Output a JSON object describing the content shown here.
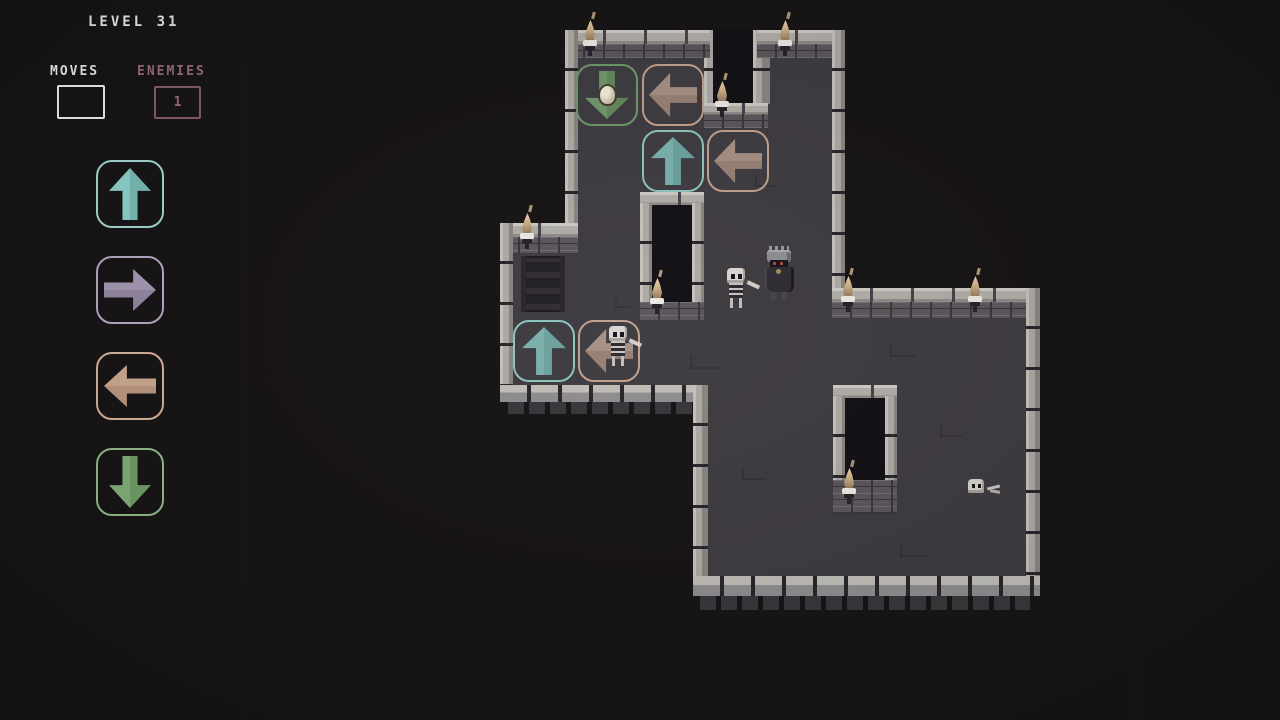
{
  "hud": {
    "level_label": "LEVEL 31",
    "moves": {
      "label": "MOVES",
      "value": ""
    },
    "enemies": {
      "label": "ENEMIES",
      "value": "1"
    }
  },
  "palette": {
    "background": "#171415",
    "floor": "#3f3c42",
    "wall_stone": "#b2afaa",
    "wall_brick": "#5b575c",
    "hud_text": "#ecebe8",
    "enemies_accent": "#9d6b80",
    "teal": "#8fd4cf",
    "lavender": "#a89bb5",
    "tan": "#cfac94",
    "green": "#83b17b",
    "torch_flame": "#c9a87f"
  },
  "controls": {
    "buttons": [
      {
        "direction": "up",
        "color": "teal"
      },
      {
        "direction": "right",
        "color": "lavender"
      },
      {
        "direction": "left",
        "color": "tan"
      },
      {
        "direction": "down",
        "color": "green"
      }
    ]
  },
  "board": {
    "placed_tiles": [
      {
        "direction": "down",
        "color": "green",
        "occupant": "egg-item",
        "position": "top room, upper row left"
      },
      {
        "direction": "left",
        "color": "tan",
        "occupant": "",
        "position": "top room, upper row right"
      },
      {
        "direction": "up",
        "color": "teal",
        "occupant": "",
        "position": "top room, lower row left"
      },
      {
        "direction": "left",
        "color": "tan",
        "occupant": "",
        "position": "top room, lower row right"
      },
      {
        "direction": "up",
        "color": "teal",
        "occupant": "",
        "position": "west room, left"
      },
      {
        "direction": "left",
        "color": "tan",
        "occupant": "skeleton",
        "position": "west room, right"
      }
    ],
    "entities": [
      {
        "type": "skeleton-swordsman",
        "position": "center hall, left of knight"
      },
      {
        "type": "armored-knight",
        "position": "center hall"
      },
      {
        "type": "skeleton-swordsman",
        "position": "standing on west left-arrow tile"
      },
      {
        "type": "egg-item",
        "position": "on green down-arrow tile"
      },
      {
        "type": "skull-debris",
        "position": "east room floor"
      }
    ],
    "decorations": [
      "wall-torch x8",
      "floor-grate",
      "doorway-pillar x2"
    ]
  }
}
